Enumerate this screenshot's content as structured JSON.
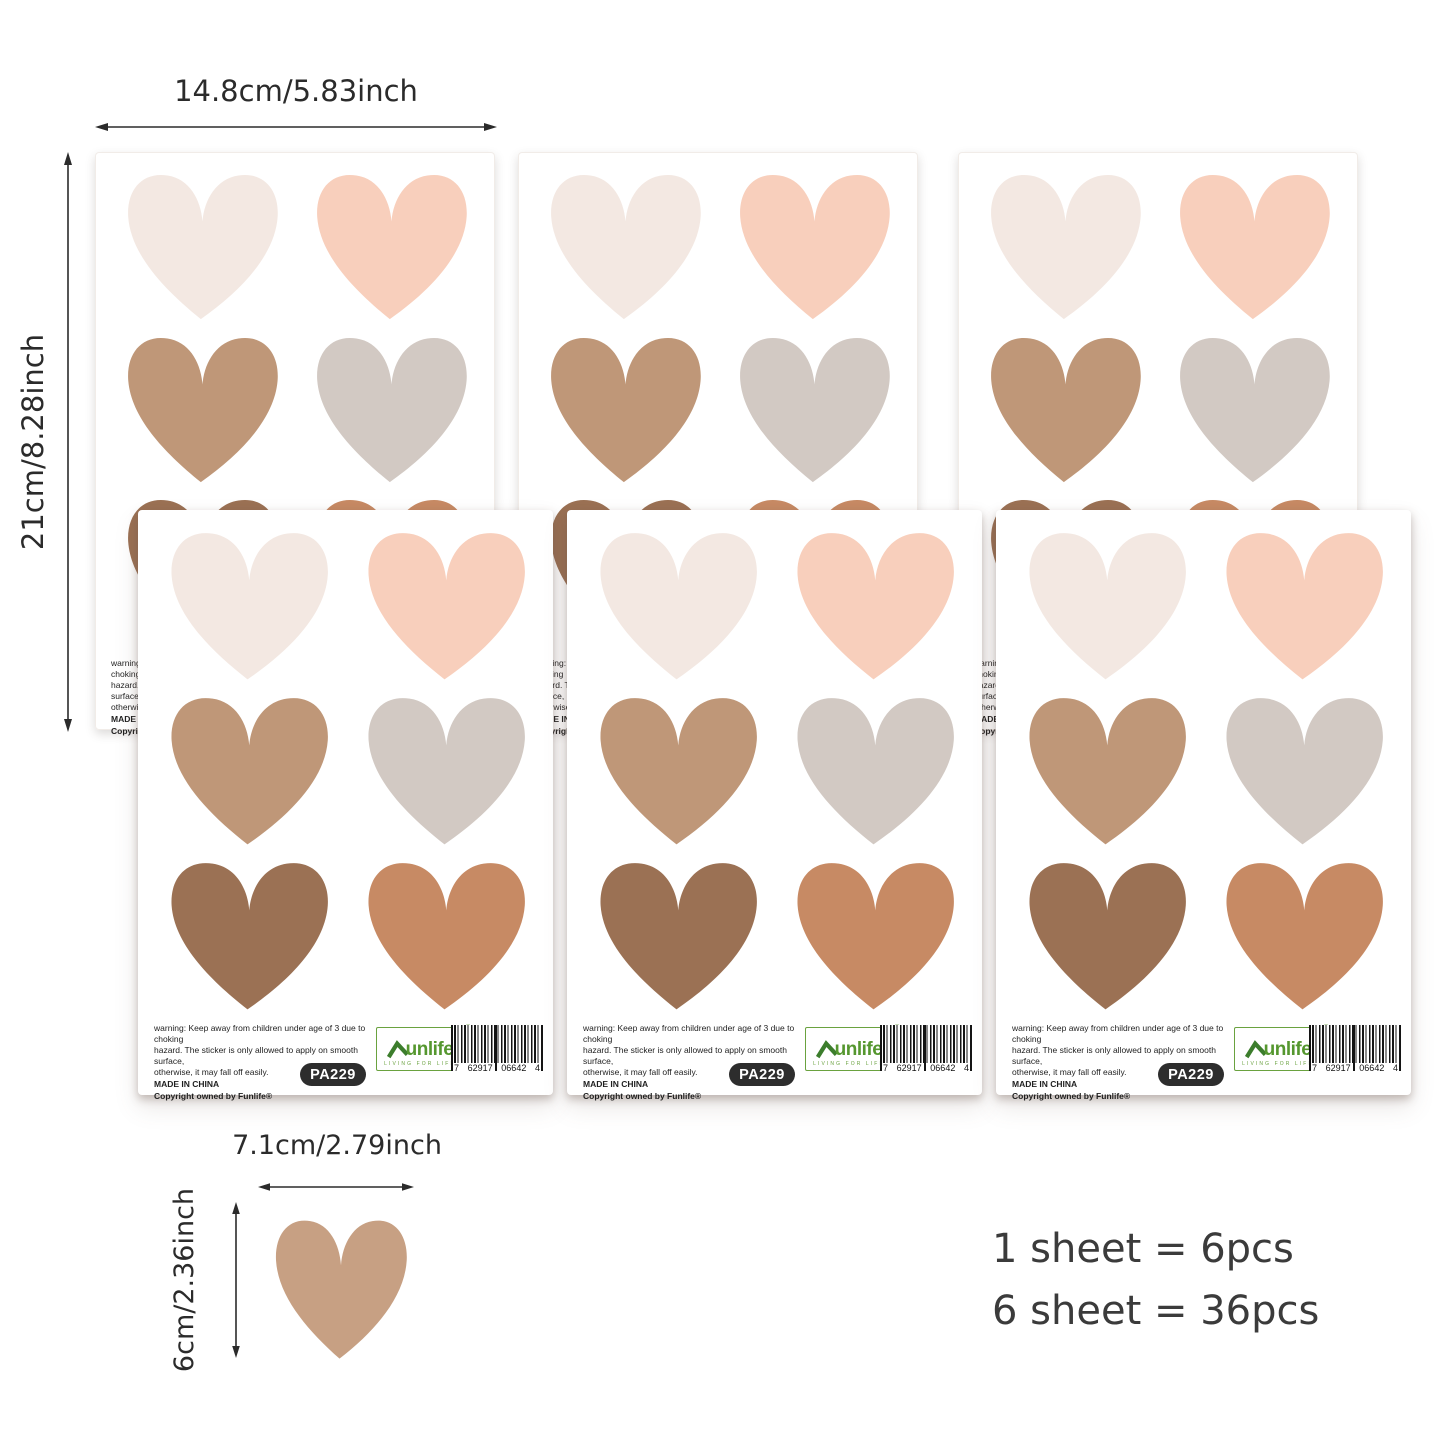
{
  "annotations": {
    "sheet_width_label": "14.8cm/5.83inch",
    "sheet_height_label": "21cm/8.28inch",
    "heart_width_label": "7.1cm/2.79inch",
    "heart_height_label": "6cm/2.36inch",
    "pcs_line_1": "1 sheet = 6pcs",
    "pcs_line_2": "6 sheet = 36pcs"
  },
  "sheet": {
    "warning_line_1": "warning: Keep away from children under age of 3 due to choking",
    "warning_line_2": "hazard. The sticker is only allowed to apply on smooth surface,",
    "warning_line_3": "otherwise, it may fall off easily.",
    "made_in": "MADE IN CHINA",
    "copyright": "Copyright owned by Funlife®",
    "model_badge": "PA229",
    "logo_brand": "unlife",
    "logo_tagline": "LIVING FOR LIFE",
    "logo_registered": "®",
    "barcode_digit_groups": [
      "7",
      "62917",
      "06642",
      "4"
    ]
  },
  "hearts": {
    "names": [
      "cream",
      "peach",
      "tan",
      "gray",
      "brown",
      "terracotta"
    ],
    "colors": [
      "#f3e8e2",
      "#f8cfbc",
      "#bf9778",
      "#d2c9c3",
      "#9b7154",
      "#c78a64"
    ],
    "single_heart_color": "#c7a083"
  },
  "colors": {
    "logo_green": "#55972f",
    "logo_roof_green": "#3c7d2c",
    "badge_background": "#2d2d2d",
    "annotation_text": "#2b2b2b"
  }
}
